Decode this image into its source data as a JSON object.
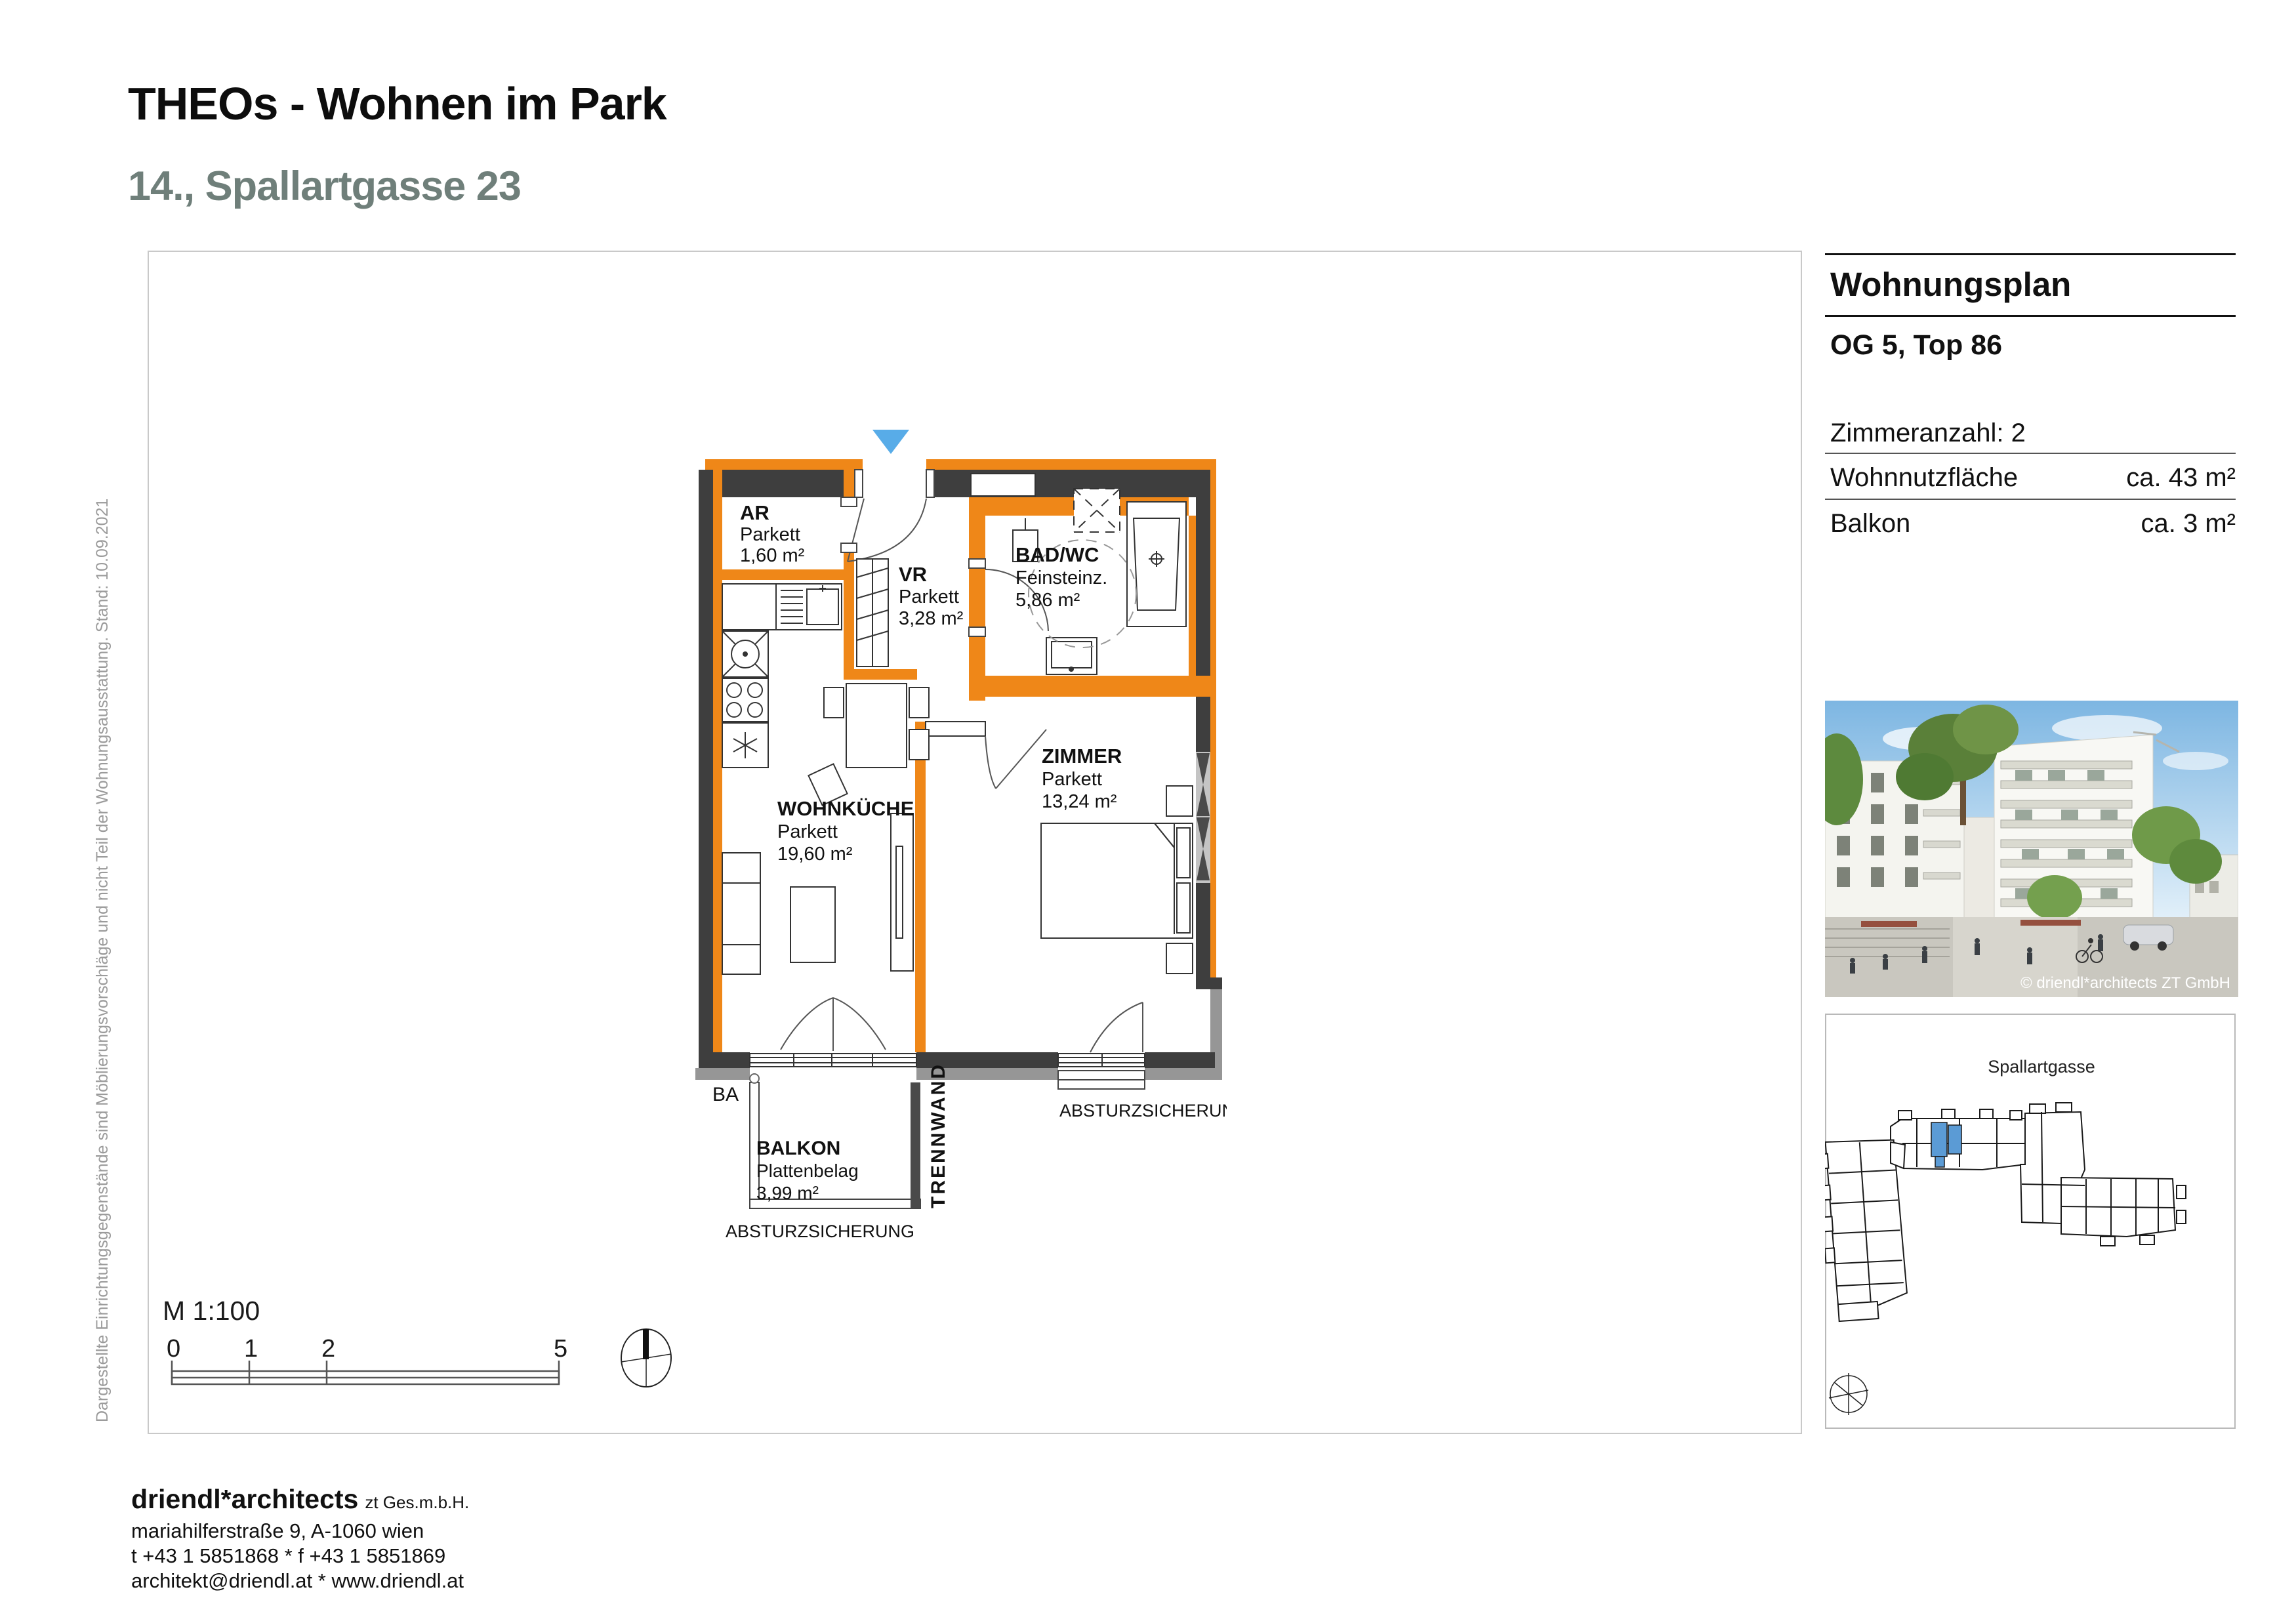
{
  "header": {
    "title": "THEOs - Wohnen im Park",
    "subtitle": "14., Spallartgasse 23"
  },
  "side_note": "Dargestellte Einrichtungsgegenstände sind Möblierungsvorschläge und nicht Teil der Wohnungsausstattung.  Stand: 10.09.2021",
  "info_panel": {
    "heading": "Wohnungsplan",
    "unit": "OG 5, Top  86",
    "rooms_label": "Zimmeranzahl: 2",
    "area_rows": [
      {
        "label": "Wohnnutzfläche",
        "value": "ca. 43 m²"
      },
      {
        "label": "Balkon",
        "value": "ca. 3 m²"
      }
    ],
    "photo_credit": "© driendl*architects ZT GmbH",
    "siteplan_street": "Spallartgasse"
  },
  "plan": {
    "colors": {
      "wall": "#3E3E3E",
      "accent_orange": "#EF8718",
      "shadow_gray": "#969696",
      "entrance_blue": "#58ACE8",
      "siteplan_highlight": "#5B9BD5"
    },
    "rooms": [
      {
        "name": "AR",
        "floor": "Parkett",
        "area": "1,60 m²"
      },
      {
        "name": "VR",
        "floor": "Parkett",
        "area": "3,28 m²"
      },
      {
        "name": "BAD/WC",
        "floor": "Feinsteinz.",
        "area": "5,86 m²"
      },
      {
        "name": "WOHNKÜCHE",
        "floor": "Parkett",
        "area": "19,60 m²"
      },
      {
        "name": "ZIMMER",
        "floor": "Parkett",
        "area": "13,24 m²"
      },
      {
        "name": "BALKON",
        "floor": "Plattenbelag",
        "area": "3,99 m²"
      }
    ],
    "annotations": {
      "railing_balcony": "ABSTURZSICHERUNG",
      "railing_room": "ABSTURZSICHERUNG",
      "partition": "TRENNWAND",
      "balcony_access": "BA"
    }
  },
  "scale": {
    "label": "M 1:100",
    "ticks": [
      "0",
      "1",
      "2",
      "5"
    ]
  },
  "footer": {
    "firm": "driendl*architects",
    "firm_suffix": "zt Ges.m.b.H.",
    "address": "mariahilferstraße 9, A-1060 wien",
    "phone": "t +43 1 5851868 * f +43 1 5851869",
    "web": "architekt@driendl.at  *  www.driendl.at"
  }
}
